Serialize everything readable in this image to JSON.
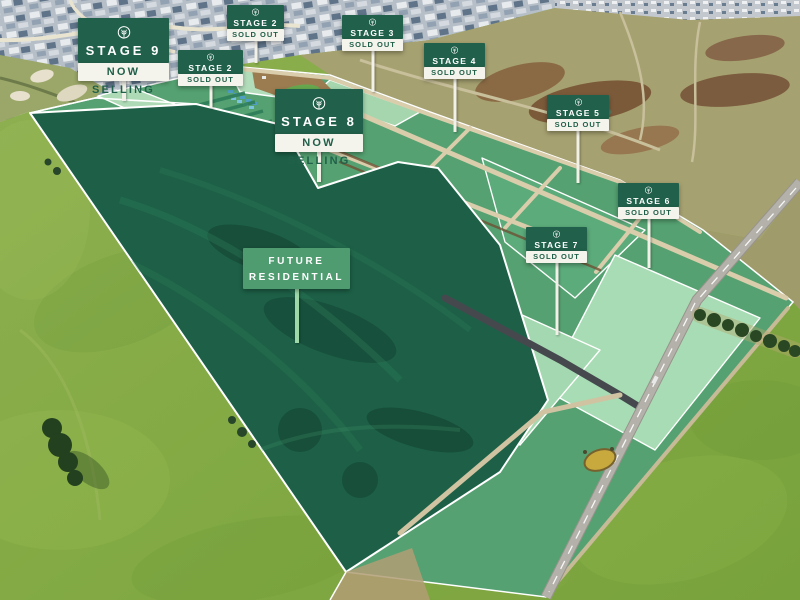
{
  "page": {
    "type": "aerial-masterplan",
    "description": "Aerial drone photo of a residential land estate with stage signage overlays"
  },
  "signs": [
    {
      "id": "stage-2-north",
      "title": "STAGE 2",
      "status": "SOLD OUT"
    },
    {
      "id": "stage-3",
      "title": "STAGE 3",
      "status": "SOLD OUT"
    },
    {
      "id": "stage-4",
      "title": "STAGE 4",
      "status": "SOLD OUT"
    },
    {
      "id": "stage-5",
      "title": "STAGE 5",
      "status": "SOLD OUT"
    },
    {
      "id": "stage-6",
      "title": "STAGE 6",
      "status": "SOLD OUT"
    },
    {
      "id": "stage-7",
      "title": "STAGE 7",
      "status": "SOLD OUT"
    },
    {
      "id": "stage-2-west",
      "title": "STAGE 2",
      "status": "SOLD OUT"
    },
    {
      "id": "stage-9",
      "title": "STAGE 9",
      "status": "NOW SELLING"
    },
    {
      "id": "stage-8",
      "title": "STAGE 8",
      "status": "NOW SELLING"
    }
  ],
  "future_area": {
    "line1": "FUTURE",
    "line2": "RESIDENTIAL"
  },
  "icons": [
    {
      "name": "tree-icon",
      "meaning": "estate brand tree inside circle"
    }
  ],
  "colors": {
    "sign_green": "#21604a",
    "sign_board_white": "#f4f3ec",
    "future_board_green": "#4f9c70",
    "future_post_green": "#9ed8a8",
    "parcel_mid_green": "#55a171",
    "parcel_pale_mint": "#a8dcb4",
    "future_parcel_dark_green": "#1d6047",
    "pasture_green": "#82aa44",
    "field_olive": "#a6a171",
    "road_tan": "#d9cdab",
    "sealed_road_grey": "#b3b1a9"
  }
}
